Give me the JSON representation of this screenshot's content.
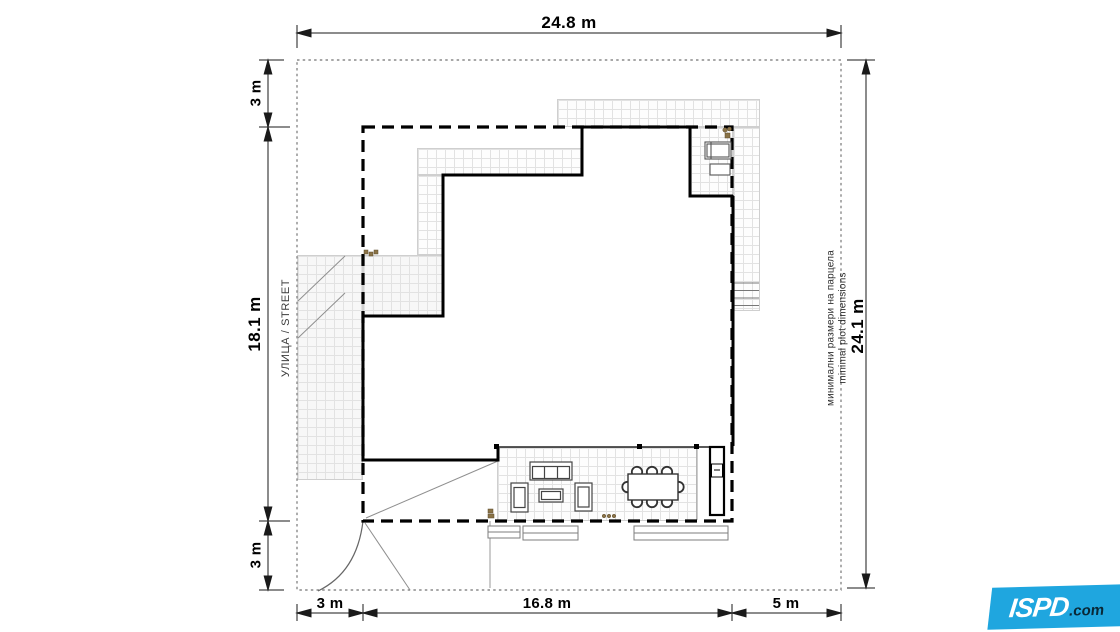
{
  "plan": {
    "top_dimension": "24.8 m",
    "left": {
      "setback_top": "3 m",
      "plot_depth": "18.1 m",
      "setback_bottom": "3 m",
      "street": "УЛИЦА / STREET"
    },
    "bottom": {
      "setback_left": "3 m",
      "house_width": "16.8 m",
      "setback_right": "5 m"
    },
    "right": {
      "plot_height": "24.1 m",
      "note_bg": "минимални размери на парцела",
      "note_en": "minimal plot dimensions"
    }
  },
  "logo": {
    "brand": "ISPD",
    "suffix": ".com",
    "color": "#1FA6DF"
  },
  "colors": {
    "walls": "#000000",
    "setback_line": "#000000",
    "plot_boundary": "#8a8a8a",
    "tile_grid": "#e2e2e2",
    "logo_blue": "#1FA6DF"
  }
}
